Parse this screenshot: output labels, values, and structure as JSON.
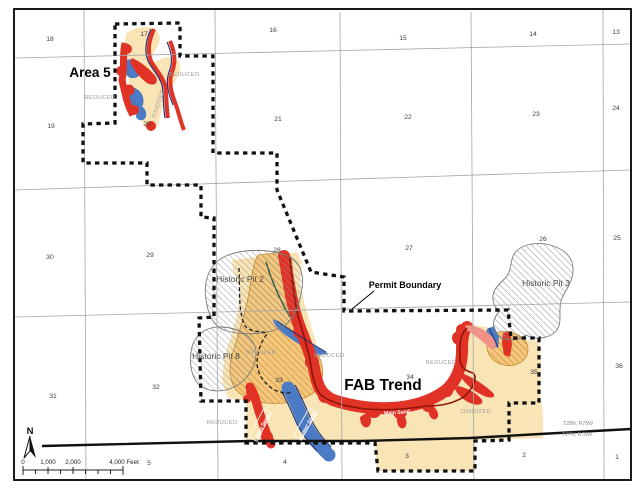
{
  "map": {
    "labels": {
      "area5": "Area 5",
      "fab_trend": "FAB Trend",
      "permit_boundary": "Permit Boundary"
    },
    "pits": {
      "pit2": "Historic Pit 2",
      "pit8": "Historic Pit 8",
      "pit3": "Historic Pit 3"
    },
    "township": {
      "north": "T28N, R78W",
      "south": "T27N, R78W"
    },
    "north_arrow": {
      "label": "N"
    },
    "scale": {
      "t0": "0",
      "t1": "1,000",
      "t2": "2,000",
      "t4": "4,000 Feet"
    },
    "section_numbers": [
      {
        "n": "18",
        "x": 50,
        "y": 41
      },
      {
        "n": "17",
        "x": 144,
        "y": 36
      },
      {
        "n": "16",
        "x": 273,
        "y": 32
      },
      {
        "n": "15",
        "x": 403,
        "y": 40
      },
      {
        "n": "14",
        "x": 533,
        "y": 36
      },
      {
        "n": "13",
        "x": 616,
        "y": 34
      },
      {
        "n": "19",
        "x": 51,
        "y": 128
      },
      {
        "n": "20",
        "x": 147,
        "y": 126
      },
      {
        "n": "21",
        "x": 278,
        "y": 121
      },
      {
        "n": "22",
        "x": 408,
        "y": 119
      },
      {
        "n": "23",
        "x": 536,
        "y": 116
      },
      {
        "n": "24",
        "x": 616,
        "y": 110
      },
      {
        "n": "30",
        "x": 50,
        "y": 259
      },
      {
        "n": "29",
        "x": 150,
        "y": 257
      },
      {
        "n": "28",
        "x": 277,
        "y": 252
      },
      {
        "n": "27",
        "x": 409,
        "y": 250
      },
      {
        "n": "26",
        "x": 543,
        "y": 241
      },
      {
        "n": "25",
        "x": 617,
        "y": 240
      },
      {
        "n": "31",
        "x": 53,
        "y": 398
      },
      {
        "n": "32",
        "x": 156,
        "y": 389
      },
      {
        "n": "33",
        "x": 279,
        "y": 382
      },
      {
        "n": "34",
        "x": 410,
        "y": 379
      },
      {
        "n": "35",
        "x": 534,
        "y": 374
      },
      {
        "n": "36",
        "x": 619,
        "y": 368
      },
      {
        "n": "5",
        "x": 149,
        "y": 465
      },
      {
        "n": "4",
        "x": 285,
        "y": 464
      },
      {
        "n": "3",
        "x": 407,
        "y": 458
      },
      {
        "n": "2",
        "x": 524,
        "y": 457
      },
      {
        "n": "1",
        "x": 617,
        "y": 459
      }
    ],
    "zone_labels": [
      {
        "t": "REDUCED",
        "x": 100,
        "y": 99,
        "r": 0
      },
      {
        "t": "REDUCED",
        "x": 184,
        "y": 76,
        "r": 0
      },
      {
        "t": "OXIDIZED",
        "x": 160,
        "y": 104,
        "r": -72
      },
      {
        "t": "REDUCED",
        "x": 329,
        "y": 357,
        "r": 0
      },
      {
        "t": "REDUCED",
        "x": 441,
        "y": 364,
        "r": 0
      },
      {
        "t": "OXIDIZED",
        "x": 261,
        "y": 354,
        "r": 0
      },
      {
        "t": "OXIDIZED",
        "x": 476,
        "y": 413,
        "r": 0
      },
      {
        "t": "REDUCED",
        "x": 222,
        "y": 424,
        "r": 0
      }
    ],
    "sand_labels": [
      {
        "t": "Main Sand",
        "x": 262,
        "y": 426,
        "r": -63,
        "boxed": true
      },
      {
        "t": "Lower Sand",
        "x": 307,
        "y": 425,
        "r": -60,
        "boxed": true
      },
      {
        "t": "Main Sand",
        "x": 397,
        "y": 412,
        "r": -4,
        "boxed": false
      }
    ],
    "colors": {
      "oxidized_sand": "#F9E4B5",
      "gold_hatch_fill": "#F3C87E",
      "gold_hatch_line": "#C9892B",
      "roll_front_red": "#E13226",
      "pink_fringe": "#F09287",
      "lower_sand_blue": "#4C7BC6",
      "navy_line": "#1F2F77",
      "maroon_front": "#8F1408",
      "green_line": "#33604A",
      "pit_hatch_gray": "#8F8F8F"
    }
  }
}
